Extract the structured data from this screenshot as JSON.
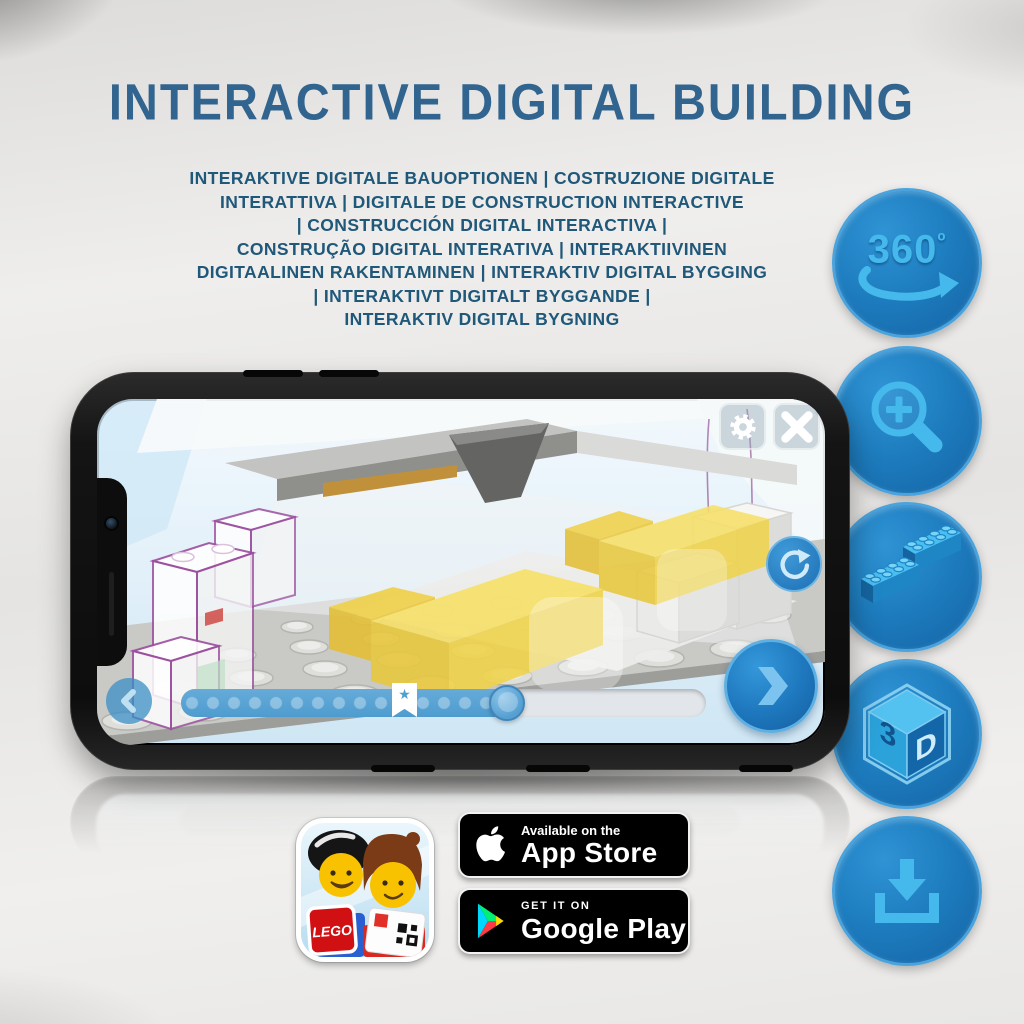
{
  "title": "INTERACTIVE DIGITAL BUILDING",
  "subtitle_lines": [
    "INTERAKTIVE DIGITALE BAUOPTIONEN | COSTRUZIONE DIGITALE",
    "INTERATTIVA | DIGITALE DE CONSTRUCTION INTERACTIVE",
    "| CONSTRUCCIÓN DIGITAL INTERACTIVA |",
    "CONSTRUÇÃO DIGITAL INTERATIVA | INTERAKTIIVINEN",
    "DIGITAALINEN RAKENTAMINEN | INTERAKTIV DIGITAL BYGGING",
    "| INTERAKTIVT DIGITALT BYGGANDE |",
    "INTERAKTIV DIGITAL BYGNING"
  ],
  "feature_icons": [
    {
      "id": "rotate-360-icon",
      "label": "360",
      "sup": "º"
    },
    {
      "id": "zoom-in-icon"
    },
    {
      "id": "lego-bricks-icon"
    },
    {
      "id": "cube-3d-icon",
      "left_label": "3",
      "right_label": "D"
    },
    {
      "id": "download-icon"
    }
  ],
  "phone_app": {
    "slider": {
      "progress_percent": 63,
      "bookmark_star": "★"
    },
    "buttons": [
      "settings-gear",
      "close",
      "rotate-view",
      "previous-step",
      "next-step"
    ]
  },
  "store_badges": {
    "lego_app": {
      "logo_text": "LEGO"
    },
    "app_store": {
      "tagline": "Available on the",
      "name": "App Store"
    },
    "google_play": {
      "tagline": "GET IT ON",
      "name": "Google Play"
    }
  },
  "colors": {
    "title_blue": "#31648e",
    "subtitle_blue": "#20587a",
    "circle_blue": "#1b75bb",
    "glyph_light_blue": "#45b8ec",
    "screen_blue": "#d9ecf7",
    "button_blue": "#2e8fd4",
    "bed_yellow": "#f6e068",
    "outline_purple": "#9b4f9e"
  }
}
